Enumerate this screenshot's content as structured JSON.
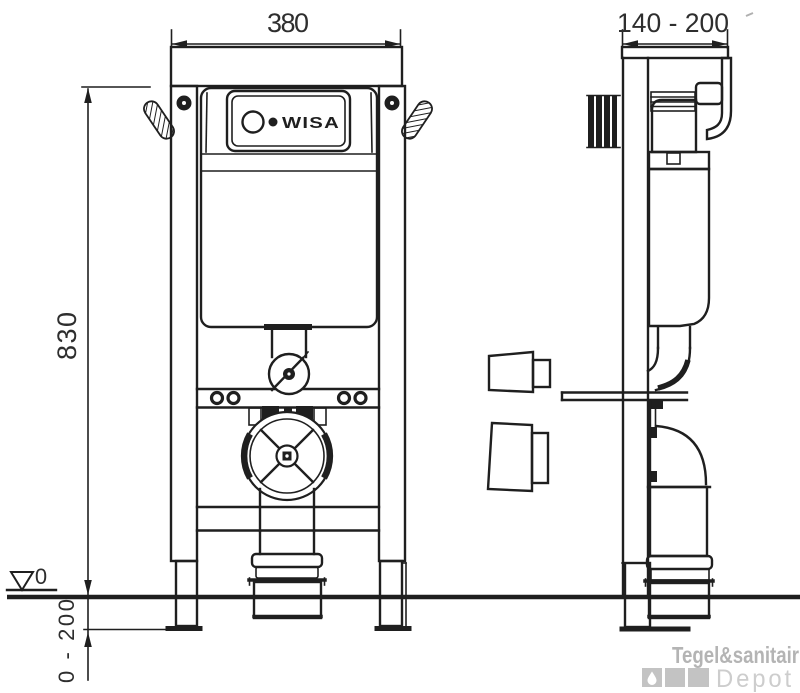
{
  "colors": {
    "line": "#1f1f1f",
    "dim_text": "#2e2e2e",
    "watermark_dark": "#b4b4b4",
    "watermark_mid": "#c3c3c3",
    "watermark_light": "#cdcdcd",
    "background": "#ffffff"
  },
  "views": {
    "front": {
      "dim_width": "380",
      "dim_height": "830",
      "dim_foot_adjust": "0 - 200",
      "floor_level": "0",
      "cistern_logo": "WISA"
    },
    "side": {
      "dim_depth": "140 - 200"
    }
  },
  "watermark": {
    "brand": "Tegel&sanitair",
    "suffix": "Depot",
    "icon": "droplet-icon"
  }
}
